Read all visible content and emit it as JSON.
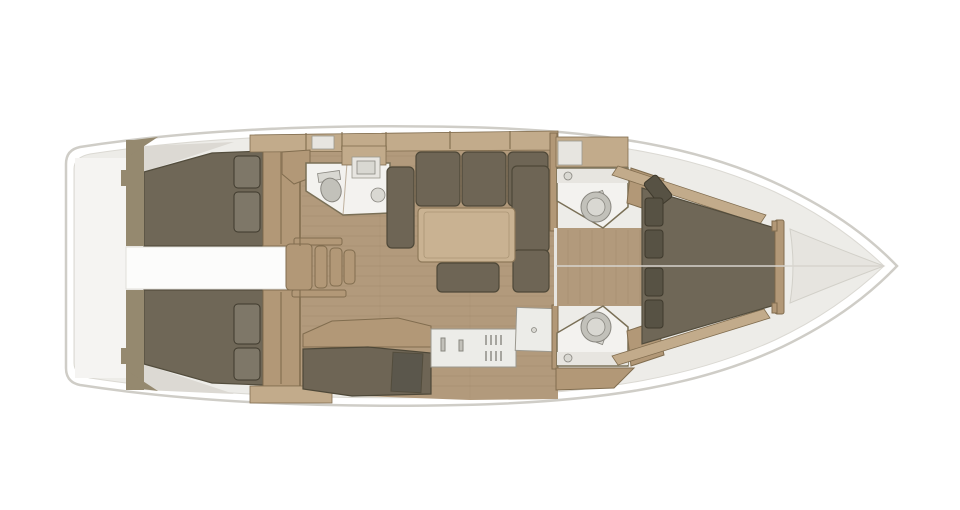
{
  "figure": {
    "type": "floor-plan",
    "subject": "Sailing yacht interior layout, top-down plan view, bow pointing right",
    "background": "#ffffff"
  },
  "colors": {
    "page_bg": "#ffffff",
    "hull_fill": "#ffffff",
    "hull_stroke": "#cfcdc7",
    "interior_fill": "#edece8",
    "interior_stroke": "#dbd9d3",
    "stern_fill": "#f5f4f2",
    "walkway_fill": "#fcfcfb",
    "bulkhead_fill": "#95896f",
    "floor_fill": "#b29a7c",
    "floor_line": "#9d8567",
    "wood_light": "#c2ab8b",
    "wood_mid": "#b29877",
    "wood_dark": "#816d4f",
    "bed_fill": "#6f6757",
    "bed_stroke": "#534d3d",
    "pillow_aft_fill": "#7e7768",
    "pillow_fwd_fill": "#575244",
    "pillow_stroke": "#3f3a2d",
    "sofa_fill": "#6e6555",
    "sofa_stroke": "#4e4838",
    "table_fill": "#c9b292",
    "table_stroke": "#8e795a",
    "room_fill": "#f3f2ef",
    "room_stroke": "#7a7057",
    "fixture_fill": "#c2c1ba",
    "fixture_light": "#d9d8d2",
    "fixture_stroke": "#898780",
    "counter_fill": "#ecece8",
    "counter_stroke": "#9b988e",
    "panel_fill": "#5b574c",
    "bow_fill": "#e6e4df",
    "bow_stroke": "#d2d0c9",
    "centerline": "#d7d4ce",
    "hullside_fill": "#dcd9d3",
    "shelf_fill": "#e7e5e0"
  },
  "components": {
    "hull": "boat hull, bow to the right",
    "aft_cabins": "two aft double cabins with berths and pillows",
    "aft_walkway": "white walkway between aft cabins",
    "companionway": "companionway steps",
    "aft_head": "aft bathroom with toilet and round sink",
    "salon": "U-shaped settee with saloon table and movable bench",
    "galley": "galley counter with sink, stove burners and worktop",
    "chart_table": "chart table with navigator seat",
    "forward_heads": "two forward bathrooms with toilets",
    "forward_cabin": "forward V-berth cabin with stacked pillows",
    "bow_locker": "bow anchor locker"
  }
}
